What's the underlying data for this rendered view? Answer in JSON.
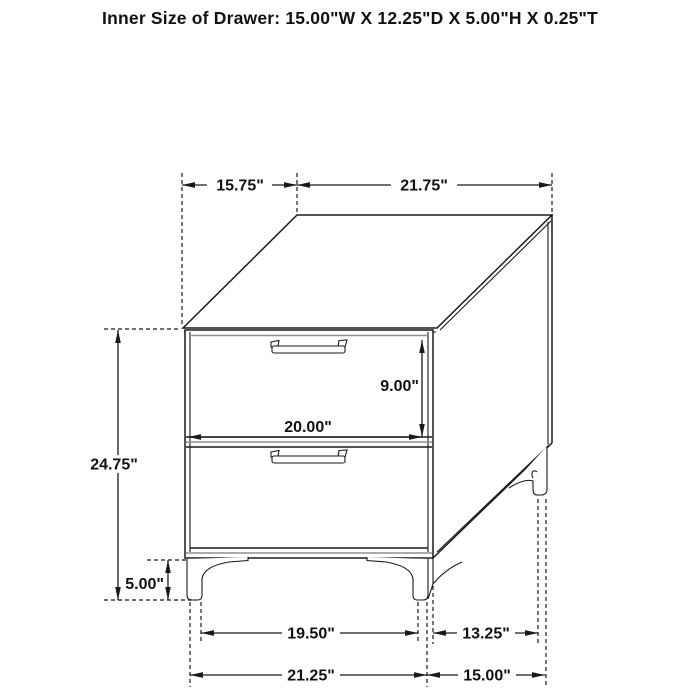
{
  "title": "Inner Size of Drawer: 15.00\"W X 12.25\"D X 5.00\"H X 0.25\"T",
  "diagram_type": "furniture dimension drawing, 2-drawer nightstand",
  "dims": {
    "top_depth": "15.75\"",
    "top_width": "21.75\"",
    "overall_height": "24.75\"",
    "leg_height": "5.00\"",
    "drawer_front_height": "9.00\"",
    "drawer_front_width": "20.00\"",
    "front_feet_inner_span": "19.50\"",
    "side_feet_span": "13.25\"",
    "front_overall_width": "21.25\"",
    "side_overall_depth": "15.00\""
  }
}
